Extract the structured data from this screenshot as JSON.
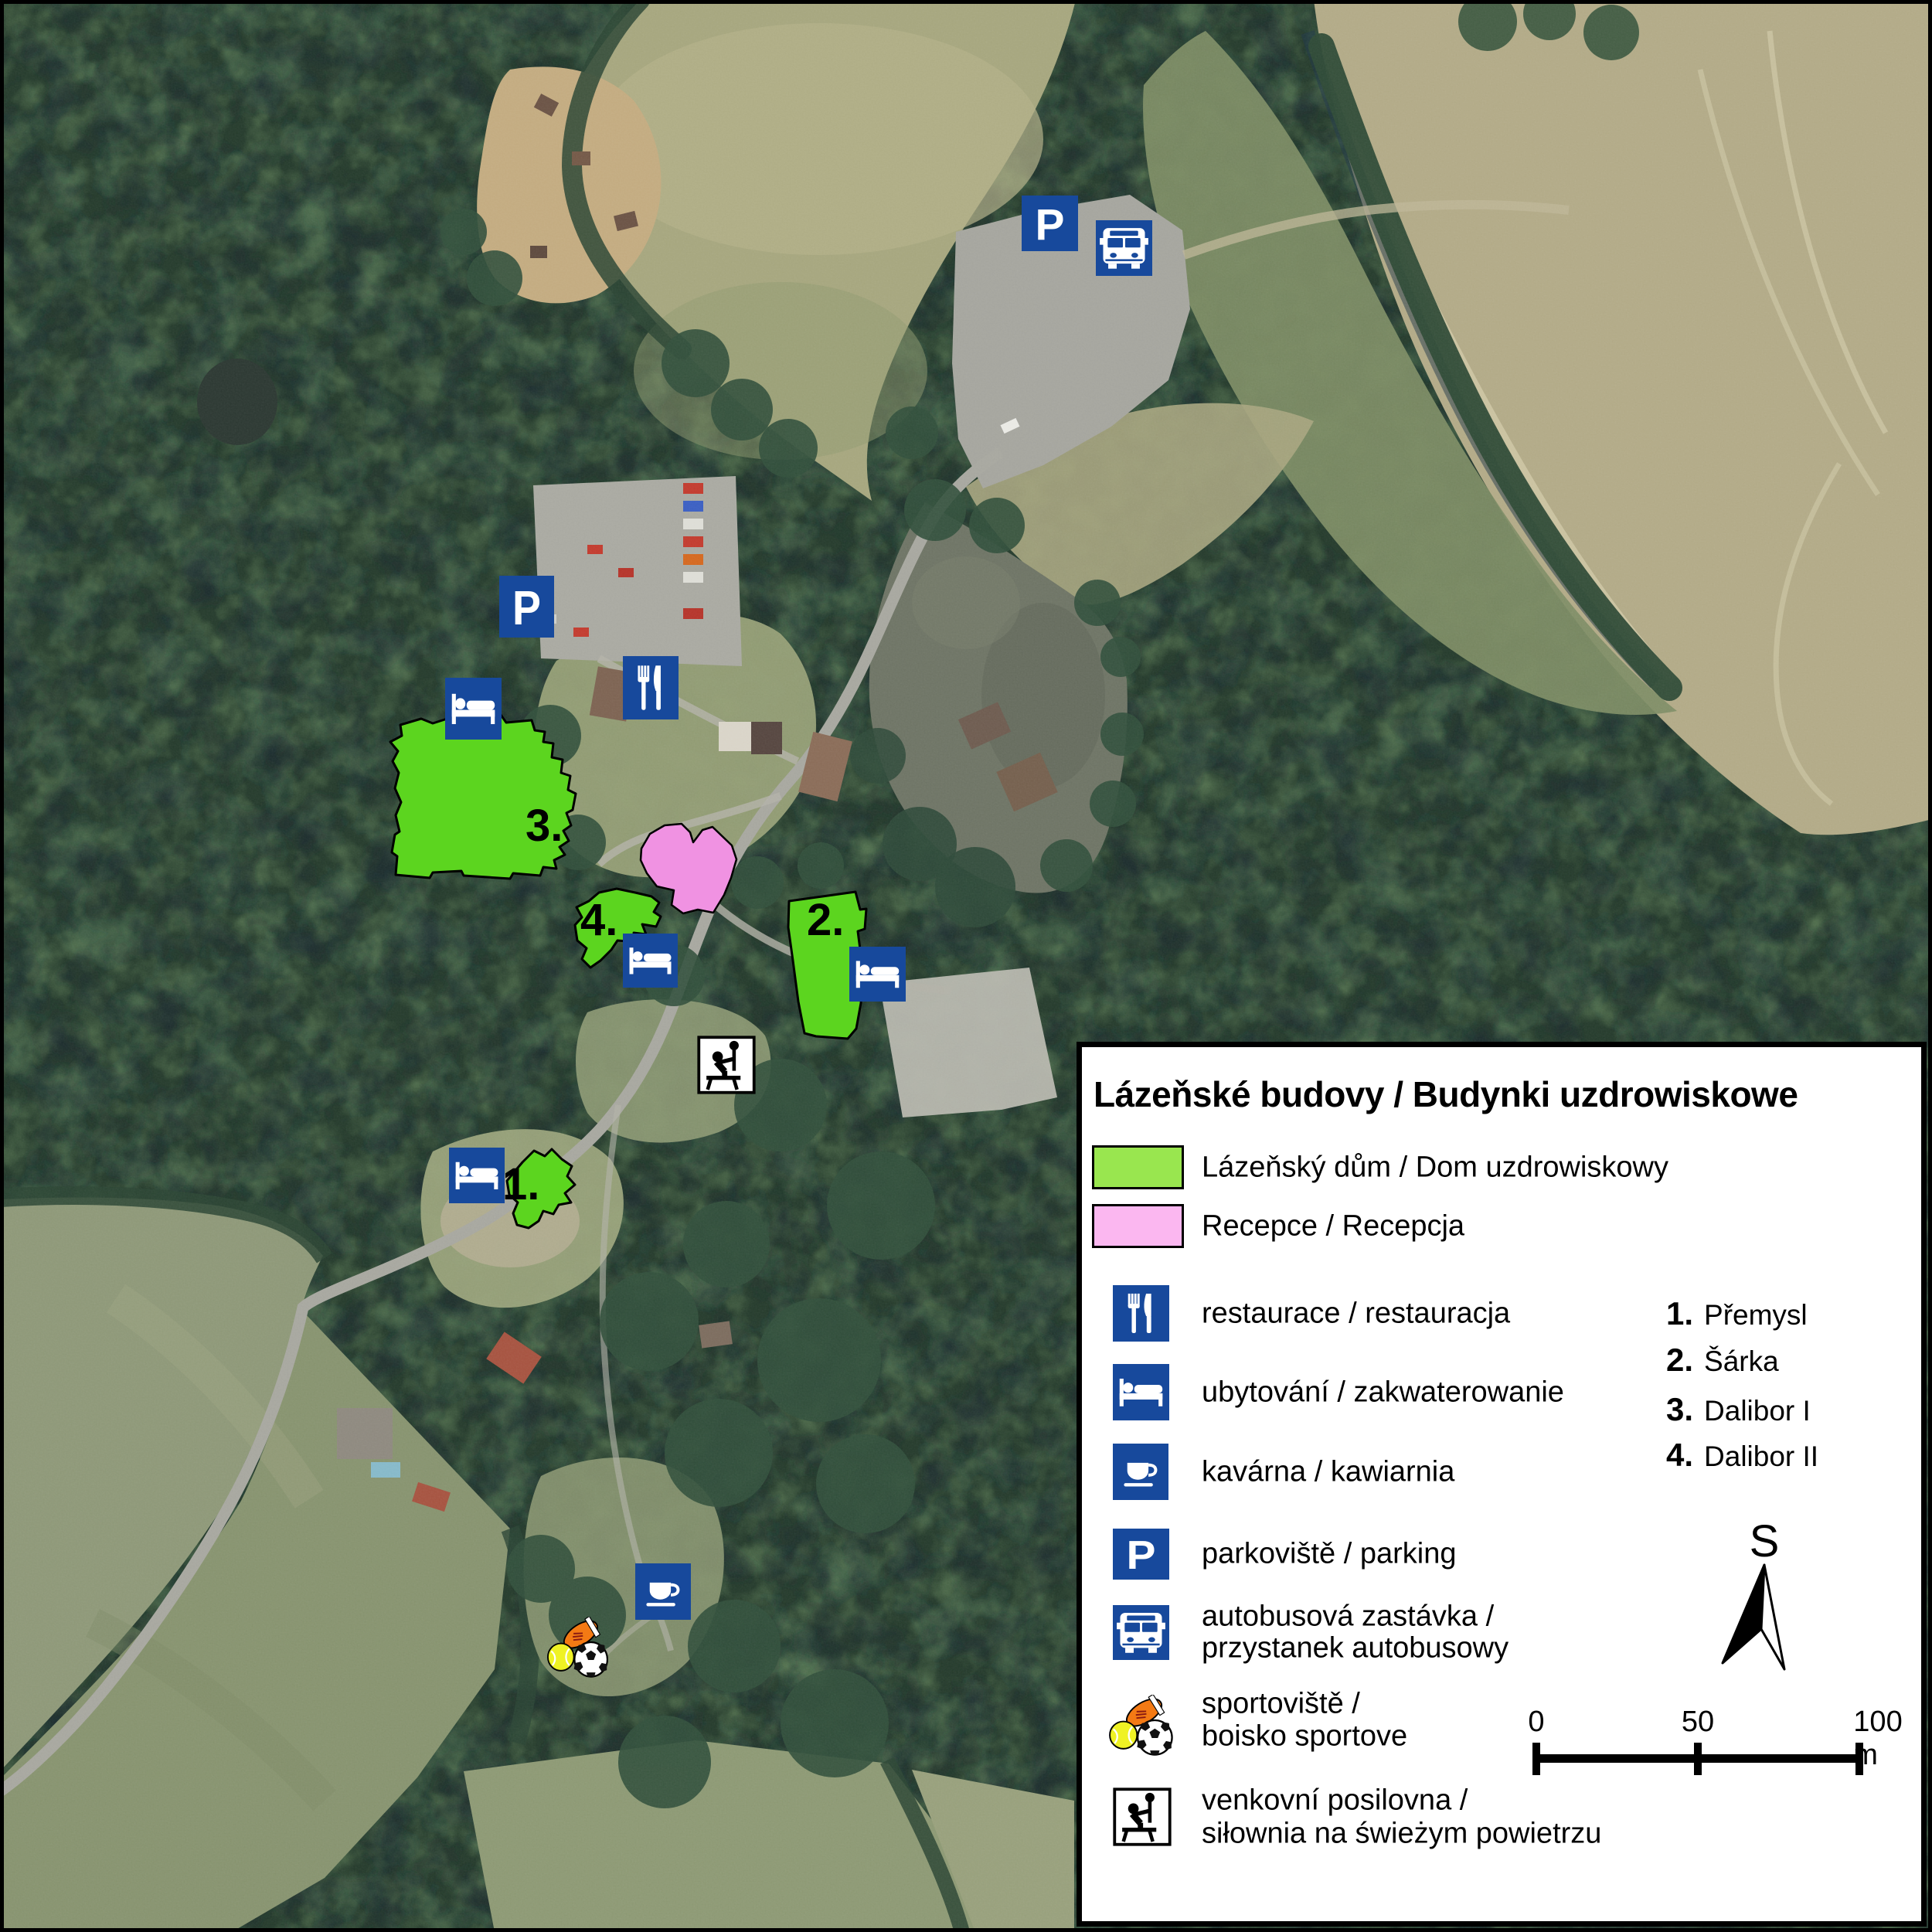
{
  "map": {
    "building_labels": [
      "1.",
      "2.",
      "3.",
      "4."
    ],
    "colors": {
      "spa_building_fill": "#5cd51f",
      "reception_fill": "#f092e2",
      "sign_blue": "#17499c",
      "forest_base": "#415f47",
      "pond": "#6e7465",
      "field_tan": "#b2aa87",
      "road_gray": "#a7a79f"
    }
  },
  "glyphs": {
    "p": "P"
  },
  "legend": {
    "title": "Lázeňské budovy / Budynki uzdrowiskowe",
    "swatches": [
      {
        "label": "Lázeňský dům / Dom uzdrowiskowy",
        "color": "#99e64f"
      },
      {
        "label": "Recepce / Recepcja",
        "color": "#fbb7f0"
      }
    ],
    "icon_rows": [
      {
        "icon": "restaurant-icon",
        "label": "restaurace / restauracja"
      },
      {
        "icon": "bed-icon",
        "label": "ubytování / zakwaterowanie"
      },
      {
        "icon": "coffee-icon",
        "label": "kavárna / kawiarnia"
      },
      {
        "icon": "parking-icon",
        "label": "parkoviště / parking"
      },
      {
        "icon": "bus-icon",
        "label": "autobusová zastávka /",
        "label2": "przystanek autobusowy"
      },
      {
        "icon": "sports-icon",
        "label": "sportoviště /",
        "label2": "boisko sportove"
      },
      {
        "icon": "gym-icon",
        "label": "venkovní posilovna /",
        "label2": "siłownia na świeżym powietrzu"
      }
    ],
    "numbered": [
      {
        "num": "1.",
        "name": "Přemysl"
      },
      {
        "num": "2.",
        "name": "Šárka"
      },
      {
        "num": "3.",
        "name": "Dalibor I"
      },
      {
        "num": "4.",
        "name": "Dalibor II"
      }
    ],
    "north_label": "S",
    "scale": {
      "t0": "0",
      "t50": "50",
      "t100": "100 m"
    }
  }
}
